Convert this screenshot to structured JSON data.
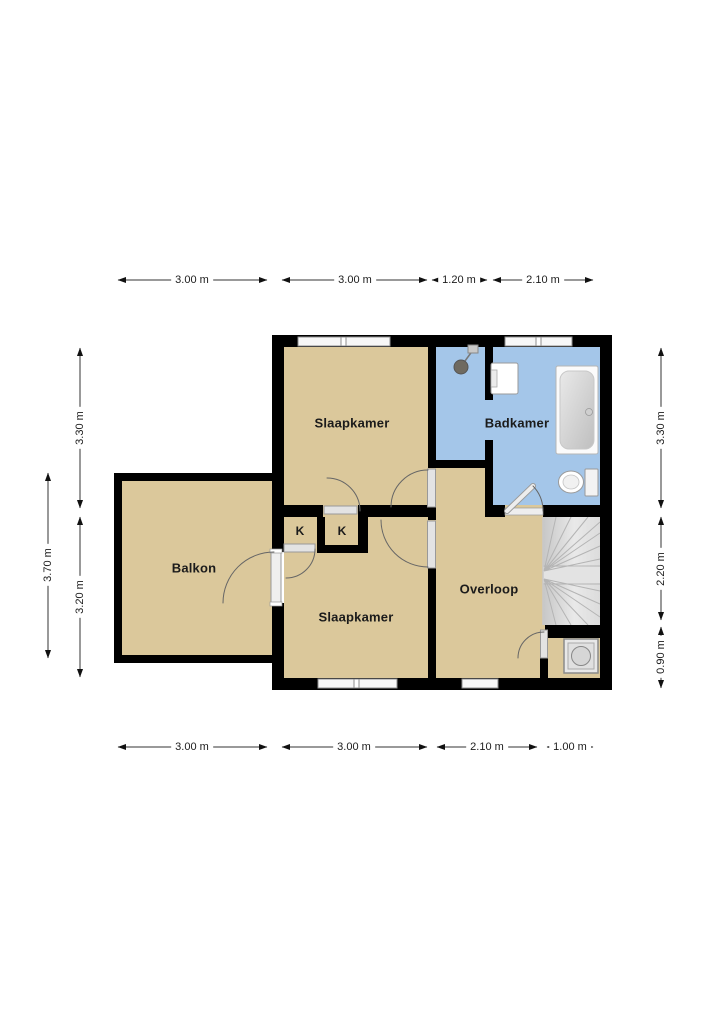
{
  "floor_plan": {
    "rooms": {
      "slaapkamer_top": "Slaapkamer",
      "badkamer": "Badkamer",
      "balkon": "Balkon",
      "slaapkamer_bottom": "Slaapkamer",
      "overloop": "Overloop",
      "closet_left": "K",
      "closet_right": "K"
    },
    "dimensions": {
      "top": [
        "3.00 m",
        "3.00 m",
        "1.20 m",
        "2.10 m"
      ],
      "bottom": [
        "3.00 m",
        "3.00 m",
        "2.10 m",
        "1.00 m"
      ],
      "left_outer": [
        "3.70 m"
      ],
      "left_inner": [
        "3.30 m",
        "3.20 m"
      ],
      "right": [
        "3.30 m",
        "2.20 m",
        "0.90 m"
      ]
    },
    "icons": {
      "shower": "shower-icon",
      "sink": "sink-icon",
      "bathtub": "bathtub-icon",
      "toilet": "toilet-icon",
      "washing_machine": "washing-machine-icon",
      "stairs": "winder-stairs"
    },
    "colors": {
      "room_fill": "#DBC89B",
      "bath_fill": "#A4C6E9",
      "stairs_fill": "#D6D6D6",
      "wall": "#000000",
      "background": "#FFFFFF"
    }
  }
}
